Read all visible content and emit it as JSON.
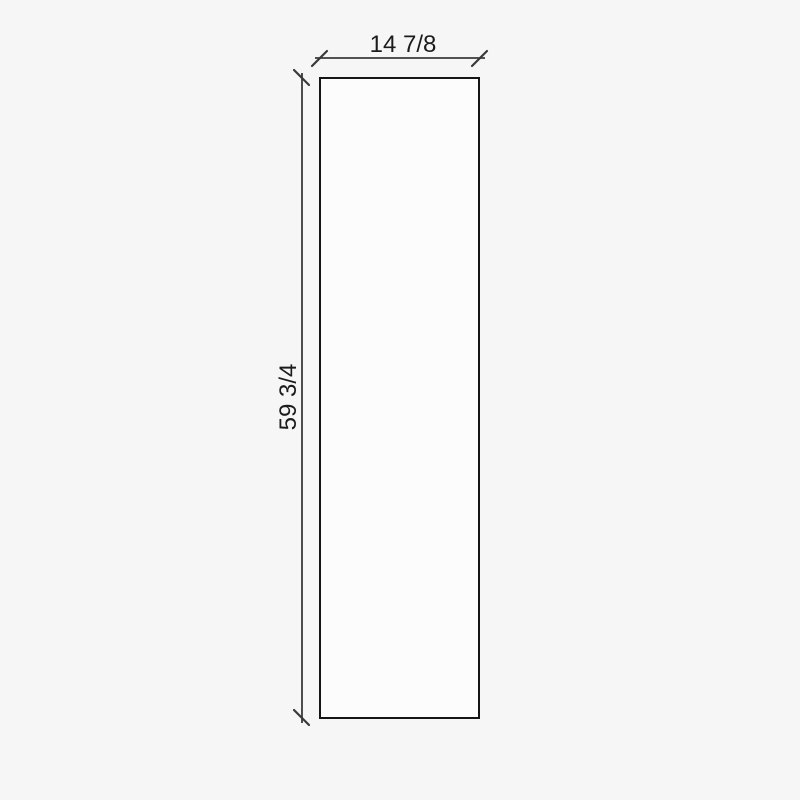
{
  "drawing": {
    "dimensions": {
      "width": {
        "label": "14 7/8"
      },
      "height": {
        "label": "59 3/4"
      }
    },
    "colors": {
      "background": "#f6f6f6",
      "panel_fill": "#fcfcfc",
      "panel_stroke": "#151515",
      "dimension_line": "#3a3a3a",
      "label_text": "#1c1c1c"
    }
  }
}
